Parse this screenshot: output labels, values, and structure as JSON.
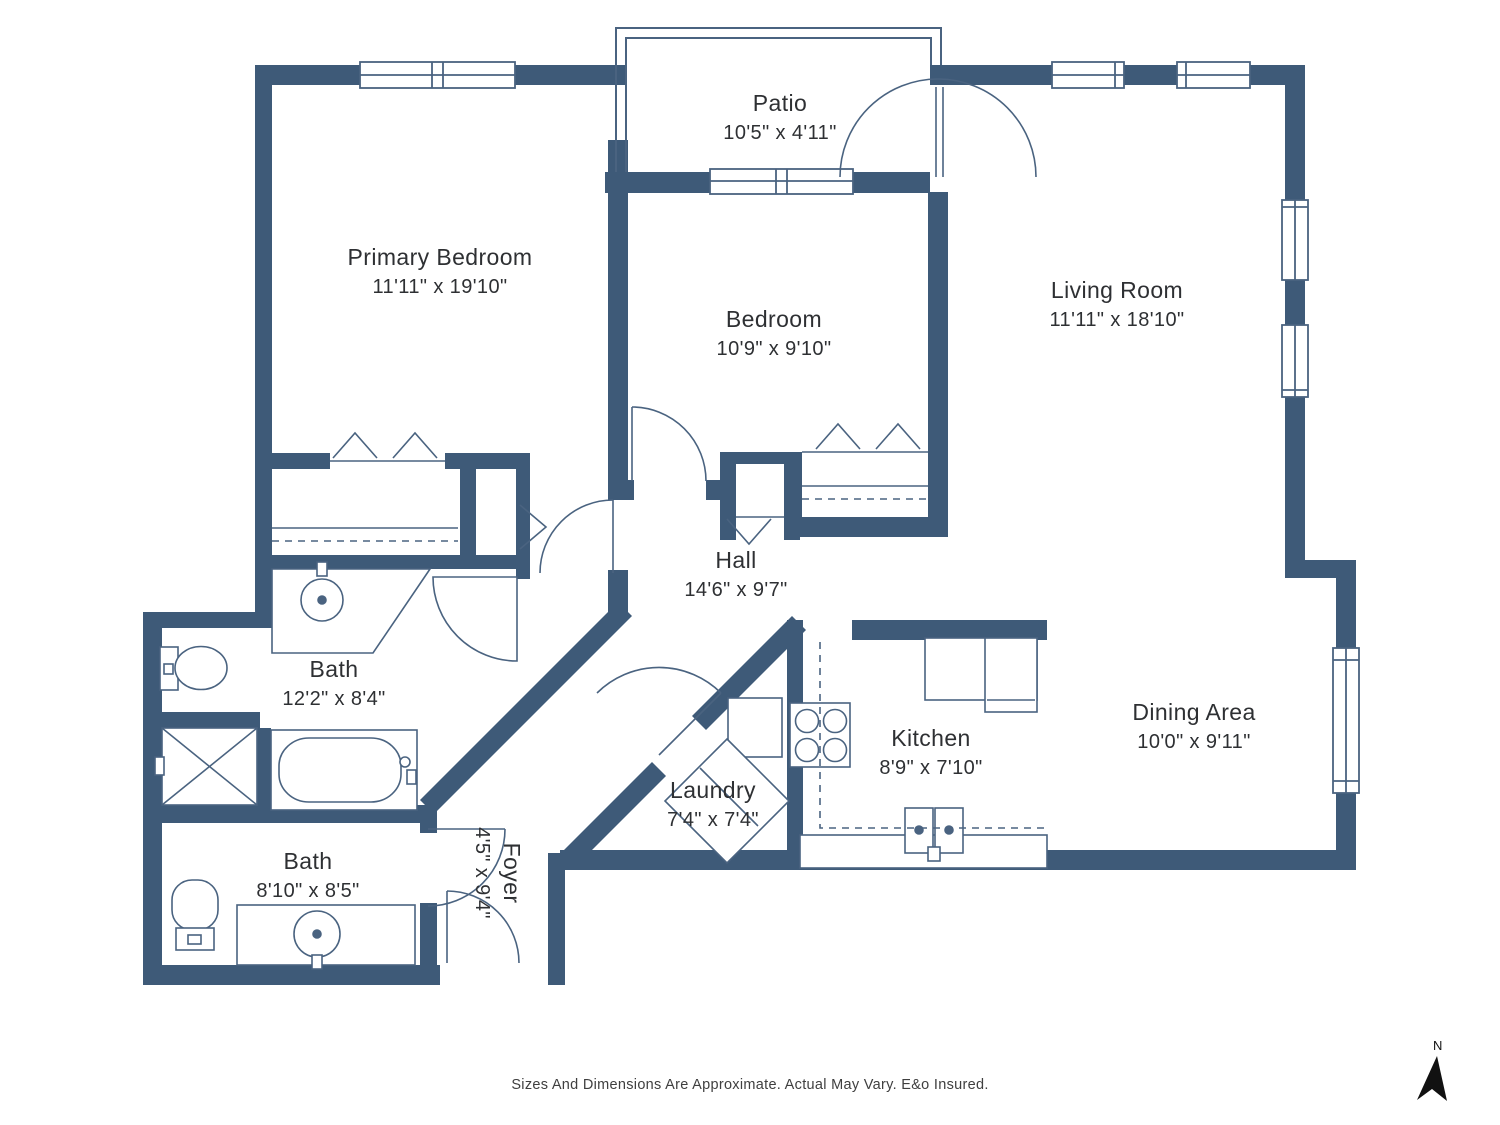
{
  "rooms": [
    {
      "name": "Patio",
      "dims": "10'5\" x 4'11\""
    },
    {
      "name": "Primary Bedroom",
      "dims": "11'11\" x 19'10\""
    },
    {
      "name": "Bedroom",
      "dims": "10'9\" x 9'10\""
    },
    {
      "name": "Living Room",
      "dims": "11'11\" x 18'10\""
    },
    {
      "name": "Hall",
      "dims": "14'6\" x 9'7\""
    },
    {
      "name": "Bath",
      "dims": "12'2\" x 8'4\""
    },
    {
      "name": "Kitchen",
      "dims": "8'9\" x 7'10\""
    },
    {
      "name": "Dining Area",
      "dims": "10'0\" x 9'11\""
    },
    {
      "name": "Laundry",
      "dims": "7'4\" x 7'4\""
    },
    {
      "name": "Bath",
      "dims": "8'10\" x 8'5\""
    },
    {
      "name": "Foyer",
      "dims": "4'5\" x 9'4\""
    }
  ],
  "footer": {
    "disclaimer": "Sizes And Dimensions Are Approximate. Actual May Vary. E&o Insured."
  },
  "compass": {
    "label": "N"
  },
  "colors": {
    "wall": "#3E5A78",
    "line": "#4A6380",
    "text": "#2E3033",
    "footer_text": "#3F3F3F",
    "compass": "#111111",
    "background": "#FFFFFF"
  }
}
